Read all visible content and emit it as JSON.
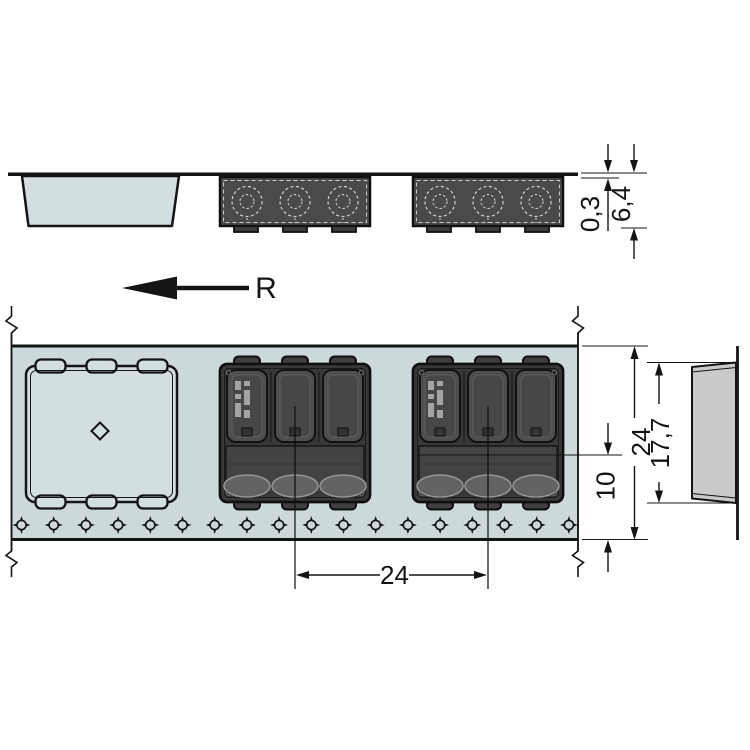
{
  "drawing": {
    "direction_label": "R"
  },
  "dimensions": {
    "tape_thickness": "0,3",
    "overall_height": "6,4",
    "tape_width": "24",
    "pocket_length": "17,7",
    "center_to_tape_edge": "10",
    "pocket_pitch": "24"
  },
  "colors": {
    "background": "#ffffff",
    "tape_fill": "#ccd8d9",
    "pocket_fill": "#d2dedf",
    "component_body": "#383838",
    "component_channel": "#4e4e4e",
    "end_view_pocket_fill": "#c9c9c9",
    "line_color": "#141414"
  }
}
